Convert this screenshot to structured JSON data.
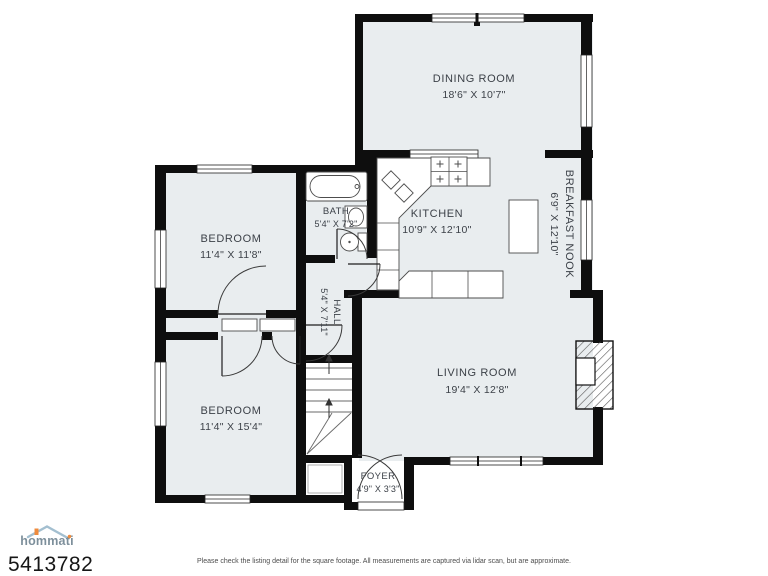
{
  "floor_plan": {
    "rooms": [
      {
        "name": "DINING ROOM",
        "dims": "18'6\" X 10'7\""
      },
      {
        "name": "KITCHEN",
        "dims": "10'9\" X 12'10\""
      },
      {
        "name": "BREAKFAST NOOK",
        "dims": "6'9\" X 12'10\""
      },
      {
        "name": "BATH",
        "dims": "5'4\" X 7'2\""
      },
      {
        "name": "HALL",
        "dims": "5'4\" X 7'11\""
      },
      {
        "name": "BEDROOM",
        "dims": "11'4\" X 11'8\""
      },
      {
        "name": "BEDROOM",
        "dims": "11'4\" X 15'4\""
      },
      {
        "name": "LIVING ROOM",
        "dims": "19'4\" X 12'8\""
      },
      {
        "name": "FOYER",
        "dims": "4'9\" X 3'3\""
      }
    ]
  },
  "footer": {
    "brand": "hommati",
    "listing_id": "5413782",
    "disclaimer": "Please check the listing detail for the square footage. All measurements are captured via lidar scan, but are approximate."
  },
  "colors": {
    "floor": "#e9edef",
    "wall": "#0e0e0e",
    "brand_text": "#7d8f9b",
    "brand_accent": "#ef8b3d"
  }
}
